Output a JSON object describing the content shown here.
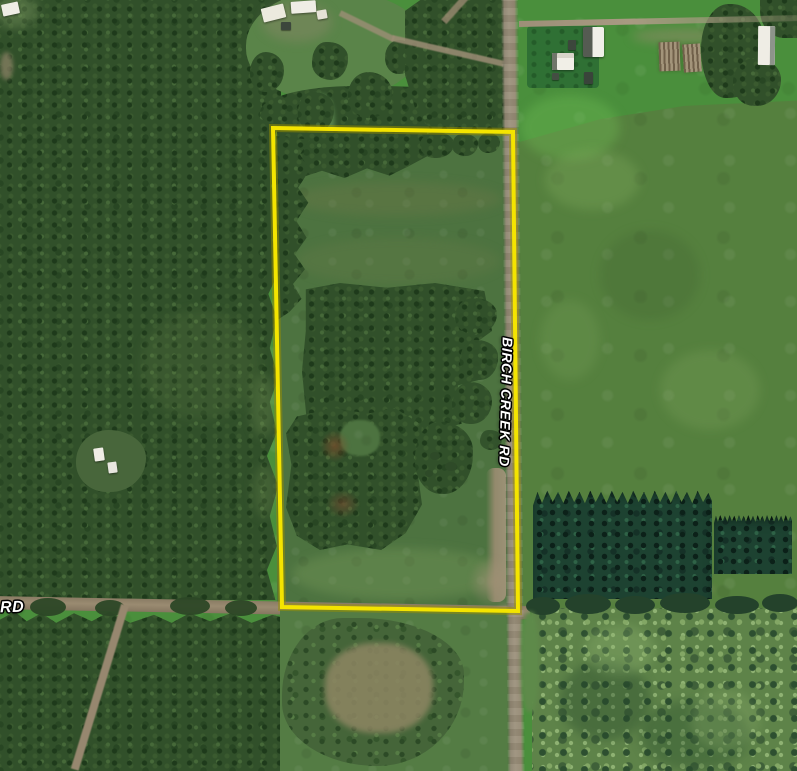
{
  "map": {
    "view": "satellite",
    "labels": {
      "birch_creek_rd": "BIRCH CREEK RD",
      "rd_partial": "RD"
    },
    "parcel_boundary": {
      "points": "273,128 513,132 518,611 282,607",
      "stroke_width": 4
    }
  },
  "colors": {
    "boundary_yellow": "#f4e400",
    "boundary_halo": "#9a8f00",
    "label_white": "#ffffff",
    "forest_dark": "#31502a",
    "conifer_dark": "#1d4231",
    "parcel_grass": "#4d7340",
    "field_bright": "#4a8f3c",
    "field_muted": "#55803e",
    "road_gravel": "#978c76",
    "road_dirt": "#8f8068",
    "building_white": "#efede5"
  }
}
